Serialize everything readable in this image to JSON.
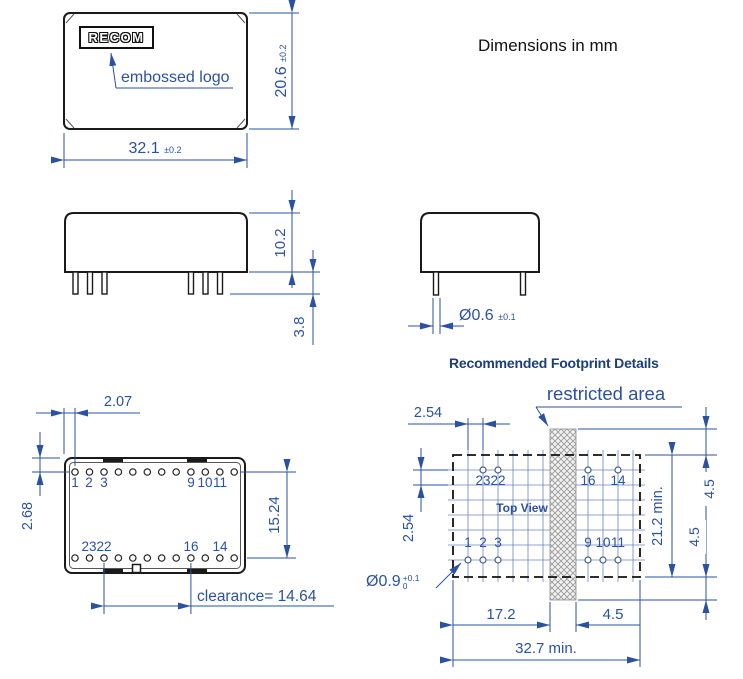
{
  "note": "Dimensions in mm",
  "colors": {
    "dimension_blue": "#2b52a0",
    "title_navy": "#1c3f77",
    "line_ink": "#1a1a1a"
  },
  "front_view": {
    "logo": "RECOM",
    "logo_callout": "embossed logo",
    "width": "32.1",
    "width_tol": "±0.2",
    "height": "20.6",
    "height_tol": "±0.2"
  },
  "side_view": {
    "body_height": "10.2",
    "pin_length": "3.8"
  },
  "end_view": {
    "pin_diameter": "Ø0.6",
    "pin_diameter_tol": "±0.1"
  },
  "bottom_view": {
    "pin_offset_x": "2.07",
    "pin_offset_y": "2.68",
    "row_spacing": "15.24",
    "clearance": "clearance= 14.64",
    "top_row_labels": [
      "1",
      "2",
      "3",
      "9",
      "10",
      "11"
    ],
    "bottom_row_labels": [
      "23",
      "22",
      "16",
      "14"
    ]
  },
  "footprint": {
    "title": "Recommended Footprint Details",
    "restricted_area": "restricted area",
    "pitch_x": "2.54",
    "pitch_y": "2.54",
    "view_label": "Top View",
    "hole_diameter": "Ø0.9",
    "hole_tol_plus": "+0.1",
    "hole_tol_minus": "0",
    "left_width": "17.2",
    "strip_width": "4.5",
    "total_width": "32.7 min.",
    "body_height": "21.2 min.",
    "overhang_top": "4.5",
    "overhang_bottom": "4.5",
    "top_row_labels": [
      "23",
      "22",
      "16",
      "14"
    ],
    "bottom_row_labels": [
      "1",
      "2",
      "3",
      "9",
      "10",
      "11"
    ]
  }
}
